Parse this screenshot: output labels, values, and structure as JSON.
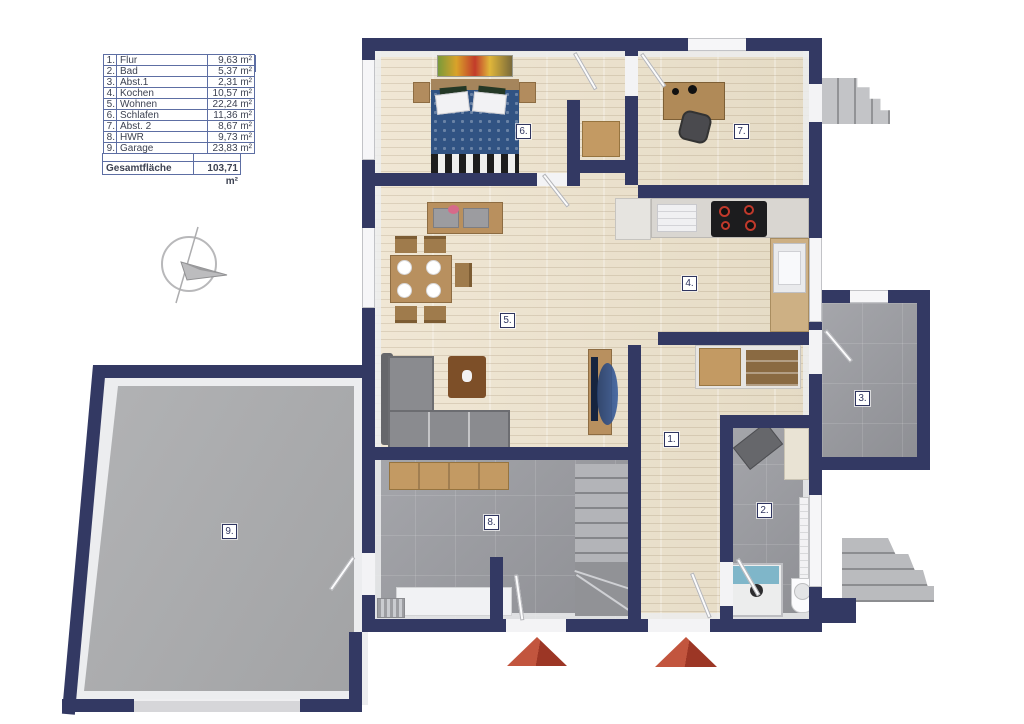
{
  "legend": {
    "title": "Kellergeschoss",
    "rows": [
      {
        "num": "1.",
        "name": "Flur",
        "area": "9,63 m²"
      },
      {
        "num": "2.",
        "name": "Bad",
        "area": "5,37 m²"
      },
      {
        "num": "3.",
        "name": "Abst.1",
        "area": "2,31 m²"
      },
      {
        "num": "4.",
        "name": "Kochen",
        "area": "10,57 m²"
      },
      {
        "num": "5.",
        "name": "Wohnen",
        "area": "22,24 m²"
      },
      {
        "num": "6.",
        "name": "Schlafen",
        "area": "11,36 m²"
      },
      {
        "num": "7.",
        "name": "Abst. 2",
        "area": "8,67 m²"
      },
      {
        "num": "8.",
        "name": "HWR",
        "area": "9,73 m²"
      },
      {
        "num": "9.",
        "name": "Garage",
        "area": "23,83 m²"
      }
    ],
    "total_label": "Gesamtfläche",
    "total_area": "103,71 m²"
  },
  "plan": {
    "floor_name": "Kellergeschoss",
    "colors": {
      "wall": "#333963",
      "wood_floor": "#ece3d0",
      "tile_floor": "#9b9ca1",
      "concrete_floor": "#abacae",
      "entrance_marker": "#b0402d",
      "badge_border": "#2f3560"
    },
    "entrance_markers": 2
  }
}
